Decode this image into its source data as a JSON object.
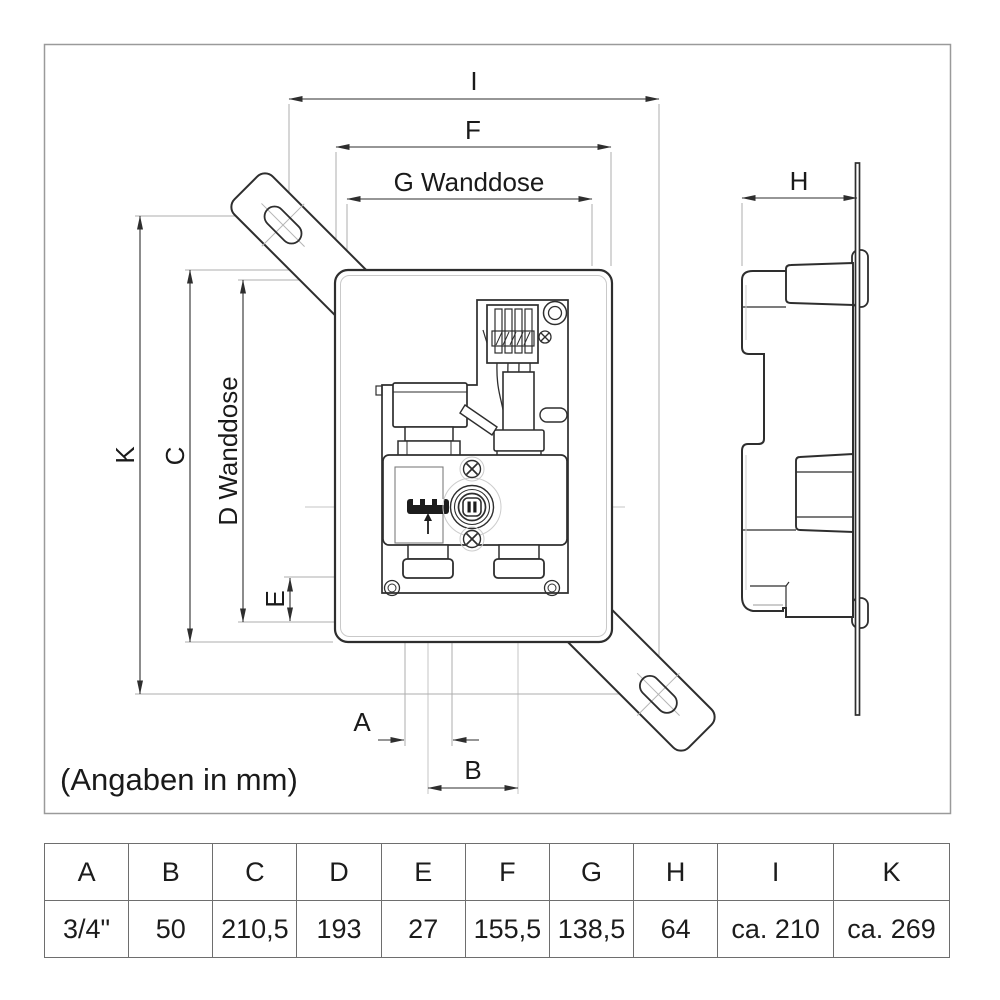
{
  "note": "(Angaben in mm)",
  "dims": {
    "I": "I",
    "F": "F",
    "G": "G Wanddose",
    "H": "H",
    "K": "K",
    "C": "C",
    "D": "D Wanddose",
    "E": "E",
    "A": "A",
    "B": "B"
  },
  "table": {
    "headers": [
      "A",
      "B",
      "C",
      "D",
      "E",
      "F",
      "G",
      "H",
      "I",
      "K"
    ],
    "values": [
      "3/4\"",
      "50",
      "210,5",
      "193",
      "27",
      "155,5",
      "138,5",
      "64",
      "ca. 210",
      "ca. 269"
    ]
  },
  "colors": {
    "line": "#2e2e2e",
    "construction": "#c6c6c6",
    "extension": "#aeaeae",
    "frame_border": "#9a9a9a",
    "table_border": "#6e6e6e"
  }
}
